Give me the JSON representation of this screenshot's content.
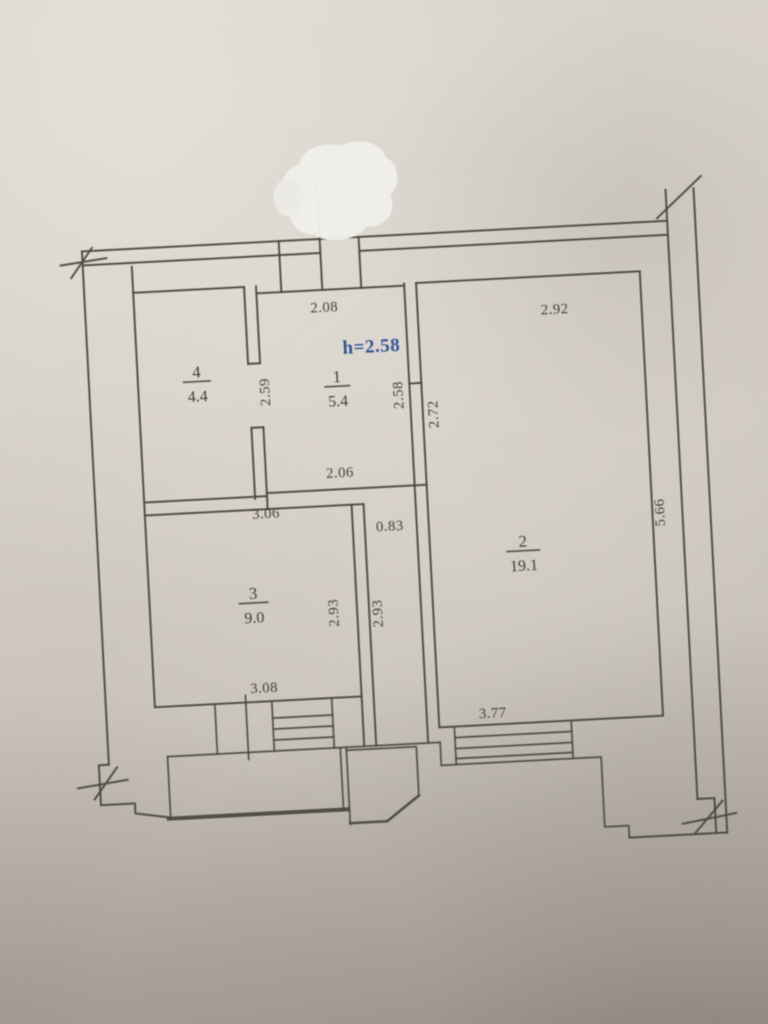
{
  "photo": {
    "description": "Apartment floor plan drawing, photographed on paper",
    "correction_blob": "white-out patch at top center"
  },
  "rooms": [
    {
      "number": "1",
      "area": "5.4"
    },
    {
      "number": "2",
      "area": "19.1"
    },
    {
      "number": "3",
      "area": "9.0"
    },
    {
      "number": "4",
      "area": "4.4"
    }
  ],
  "height_note": {
    "text": "h=2.58",
    "color": "#2b4b92"
  },
  "dimensions": {
    "entry_top": "2.08",
    "room2_top": "2.92",
    "room1_left": "2.59",
    "room1_right": "2.58",
    "room2_left": "2.72",
    "room2_right": "5.66",
    "room1_bottom": "2.06",
    "room3_top": "3.06",
    "corridor_width": "0.83",
    "room3_right": "2.93",
    "corridor_length": "2.93",
    "room3_bottom": "3.08",
    "room2_bottom": "3.77"
  },
  "colors": {
    "ink": "#4b443b",
    "paper": "#d5cfc5",
    "height_note_blue": "#2b4b92"
  }
}
